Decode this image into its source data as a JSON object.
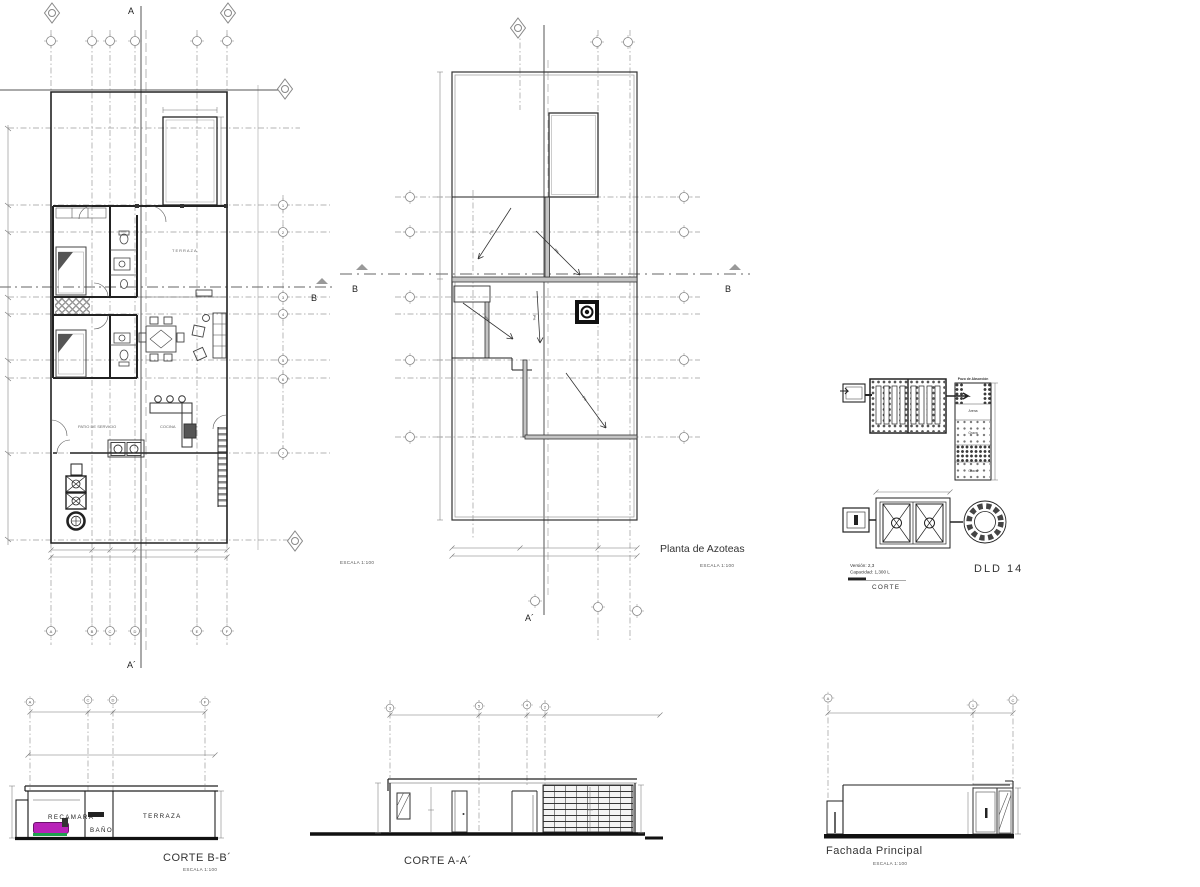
{
  "colors": {
    "paper": "#ffffff",
    "ink": "#2f2f2f",
    "grid": "#9a9a9a",
    "bed_magenta": "#b822b8",
    "bed_green": "#1fa04e"
  },
  "plan1": {
    "escala": "ESCALA 1:100",
    "rooms": {
      "terraza": "TERRAZA",
      "cocina": "COCINA",
      "patio": "PATIO DE SERVICIO"
    },
    "markers": {
      "a_top": "A",
      "a_bottom": "A´",
      "b_right": "B"
    },
    "grid_letters": [
      "A",
      "B",
      "C",
      "D",
      "E",
      "F"
    ],
    "grid_numbers": [
      "1",
      "2",
      "3",
      "4",
      "5",
      "6",
      "7"
    ]
  },
  "plan2": {
    "title": "Planta de Azoteas",
    "escala": "ESCALA 1:100",
    "slope_label": "P%",
    "markers": {
      "b_left": "B",
      "b_right": "B",
      "a_bottom": "A´"
    }
  },
  "detail": {
    "version": "Versión: 2,3",
    "capacity": "Capacidad: 1,300 L",
    "code": "DLD 14",
    "corte_label": "CORTE",
    "labels": {
      "pozo": "Pozo de Absorción",
      "arena": "Arena",
      "grava1": "Grava",
      "grava2": "Grava"
    }
  },
  "corte_bb": {
    "title": "CORTE B-B´",
    "escala": "ESCALA 1:100",
    "rooms": {
      "recamara": "RECAMARA",
      "bano": "BAÑO",
      "terraza": "TERRAZA"
    },
    "bubbles": [
      "A",
      "C",
      "D",
      "F"
    ]
  },
  "corte_aa": {
    "title": "CORTE A-A´",
    "bubbles": [
      "3",
      "5",
      "4",
      "2"
    ]
  },
  "fachada": {
    "title": "Fachada Principal",
    "escala": "ESCALA 1:100",
    "bubbles": [
      "A",
      "1",
      "C"
    ]
  }
}
